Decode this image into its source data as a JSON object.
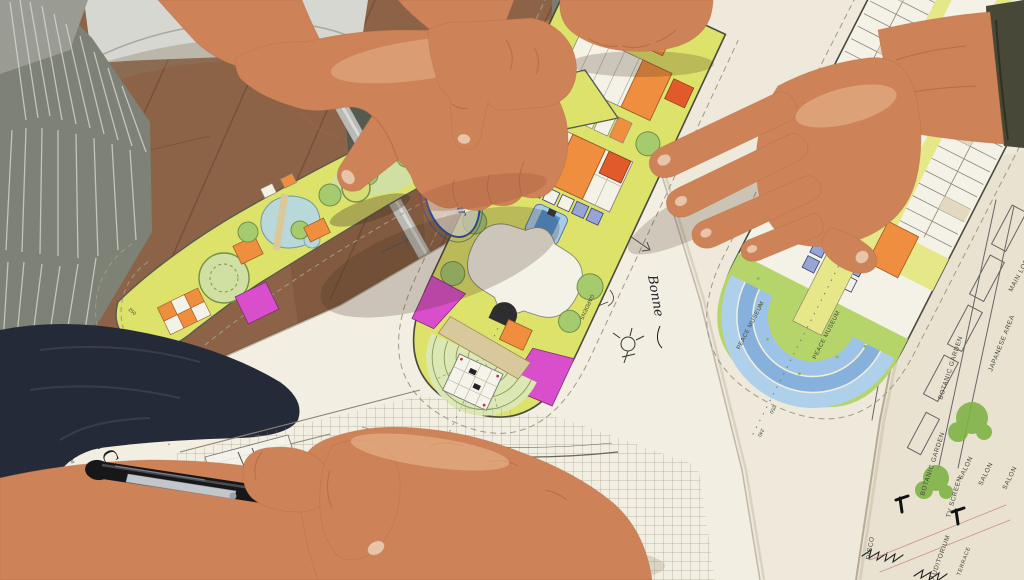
{
  "deck_sheet": {
    "title": "DECK",
    "note_a": "4000",
    "note_b": "14 440 MM",
    "tick_a": "310",
    "tick_b": "250"
  },
  "middle_plan": {
    "gardens": "GARDENS"
  },
  "right_plan": {
    "peace_museum_a": "PEACE MUSEUM",
    "peace_museum_b": "PEACE MUSEUM",
    "tick_a": "250",
    "tick_b": "240"
  },
  "side_sheet": {
    "main_lobby": "MAIN LOBBY",
    "japanese_area": "JAPANESE AREA",
    "botanic_garden_a": "BOTANIC GARDEN",
    "botanic_garden_b": "BOTANIC GARDEN",
    "salon_a": "SALON",
    "salon_b": "SALON",
    "salon_c": "SALON",
    "tv_screen": "TV SCREEN",
    "auditorium": "AUDITORIUM",
    "terrace": "TERRACE",
    "disco": "DISCO"
  },
  "handwriting": {
    "juice_bar": "Juice bar",
    "note": "Bonne"
  },
  "colors": {
    "floor": "#8d6347",
    "table": "#d7d7d1",
    "sheet": "#f2eee2",
    "deck_chartreuse": "#dde26a",
    "lawn": "#cfe0a2",
    "tree": "#a6ca6e",
    "orange": "#ee8e3e",
    "red": "#e05a2b",
    "magenta": "#d94ecb",
    "pool_blue": "#4f8fd0",
    "terrace_blue": "#86b1dd",
    "green_deck": "#b5d56a",
    "ink_blue": "#2b4fa0",
    "skin": "#cd8257",
    "pen": "#17171a",
    "navy_fabric": "#252a38"
  }
}
